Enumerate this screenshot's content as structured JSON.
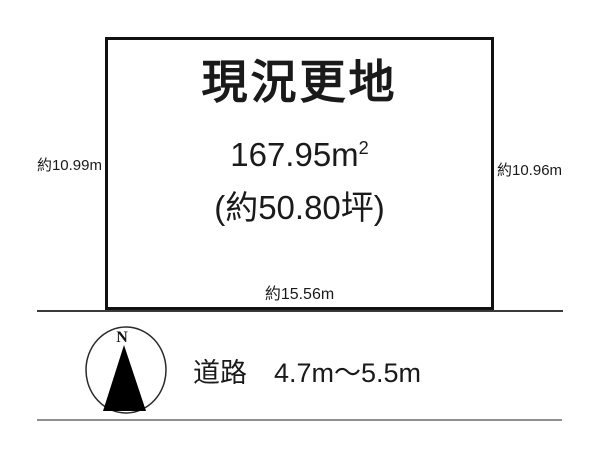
{
  "plot": {
    "title": "現況更地",
    "area_value": "167.95m",
    "area_sup": "2",
    "area_tsubo": "(約50.80坪)",
    "left_dim": "約10.99m",
    "right_dim": "約10.96m",
    "bottom_dim": "約15.56m"
  },
  "road": {
    "label": "道路　4.7m～5.5m"
  },
  "compass": {
    "icon": "north-arrow-icon",
    "north": "N"
  },
  "colors": {
    "ink": "#1a1a1a",
    "plot_border": "#111111",
    "road_top_line": "#3a3a3a",
    "road_bottom_line": "#8f8f8f",
    "background": "#ffffff"
  }
}
